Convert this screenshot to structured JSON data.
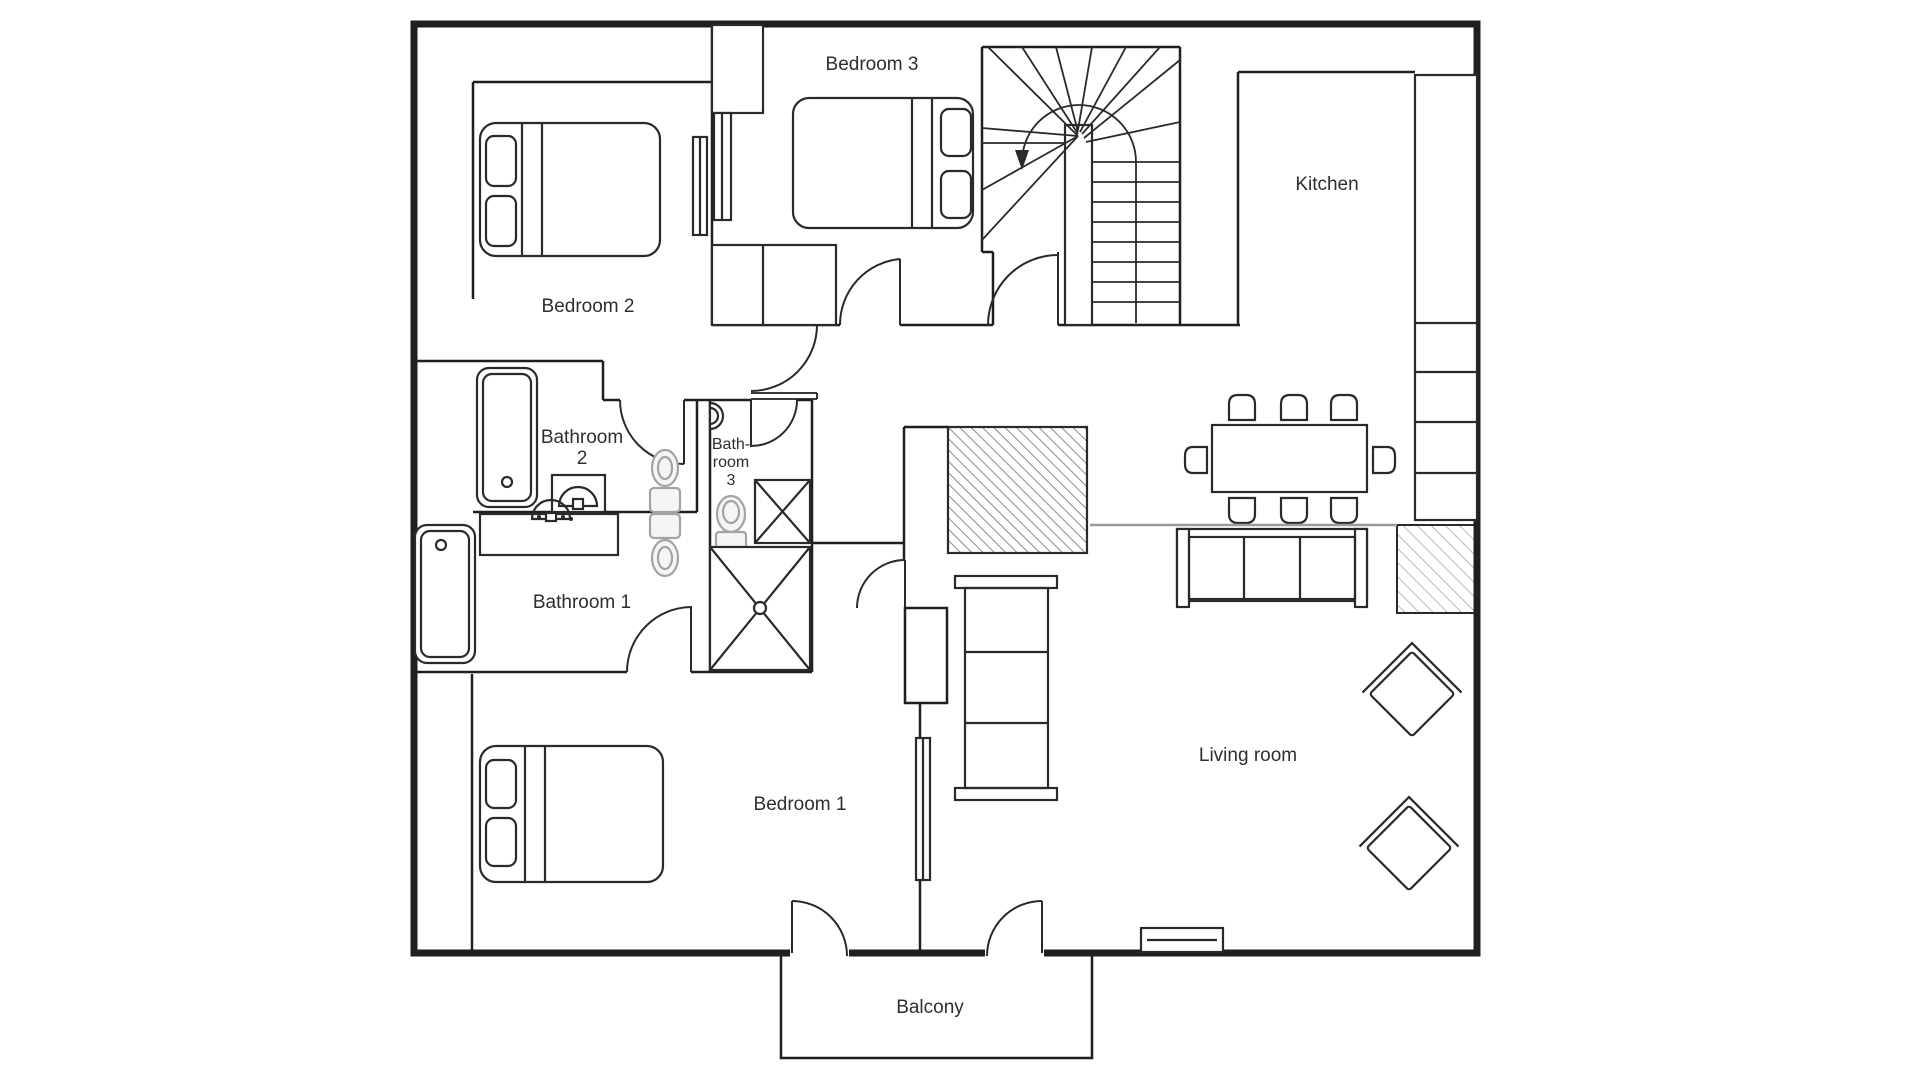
{
  "plan": {
    "type": "apartment-floor-plan",
    "labels": {
      "bedroom1": "Bedroom 1",
      "bedroom2": "Bedroom 2",
      "bedroom3": "Bedroom 3",
      "bathroom1": "Bathroom 1",
      "bathroom2_line1": "Bathroom",
      "bathroom2_line2": "2",
      "bathroom3_line1": "Bath-",
      "bathroom3_line2": "room",
      "bathroom3_line3": "3",
      "kitchen": "Kitchen",
      "living_room": "Living room",
      "balcony": "Balcony"
    },
    "colors": {
      "background": "#ffffff",
      "wall": "#1f1f1f",
      "text": "#2e2e2e",
      "gray_fixture": "#a3a3a3",
      "hatch_dark": "#6f6f6f",
      "hatch_light": "#a8a8a8",
      "floor_divider": "#9a9a9a"
    }
  }
}
